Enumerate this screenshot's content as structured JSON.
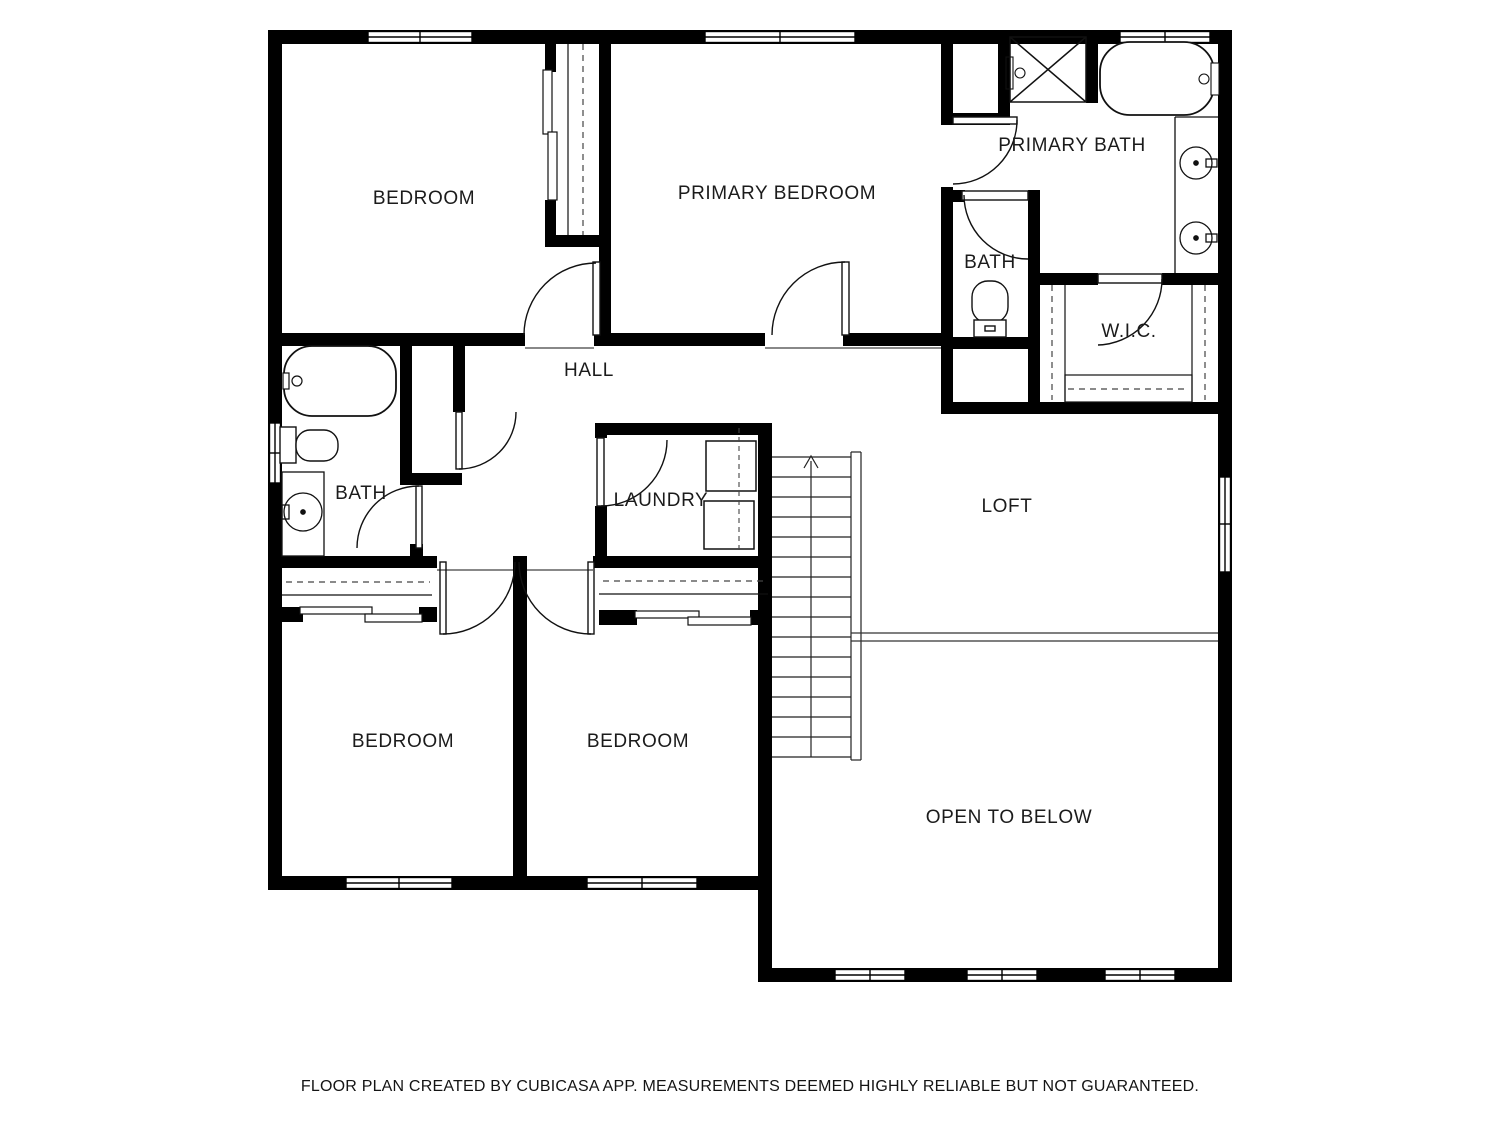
{
  "rooms": {
    "bedroom_top_left": {
      "label": "BEDROOM"
    },
    "primary_bedroom": {
      "label": "PRIMARY BEDROOM"
    },
    "primary_bath": {
      "label": "PRIMARY BATH"
    },
    "toilet_room": {
      "label": "BATH"
    },
    "walk_in_closet": {
      "label": "W.I.C."
    },
    "hall": {
      "label": "HALL"
    },
    "hall_bath": {
      "label": "BATH"
    },
    "laundry": {
      "label": "LAUNDRY"
    },
    "loft": {
      "label": "LOFT"
    },
    "bedroom_bottom_left": {
      "label": "BEDROOM"
    },
    "bedroom_bottom_middle": {
      "label": "BEDROOM"
    },
    "open_to_below": {
      "label": "OPEN TO BELOW"
    }
  },
  "footer": {
    "disclaimer": "FLOOR PLAN CREATED BY CUBICASA APP. MEASUREMENTS DEEMED HIGHLY RELIABLE BUT NOT GUARANTEED."
  },
  "colors": {
    "walls": "#000000",
    "background": "#ffffff",
    "text": "#1b1b1b"
  }
}
